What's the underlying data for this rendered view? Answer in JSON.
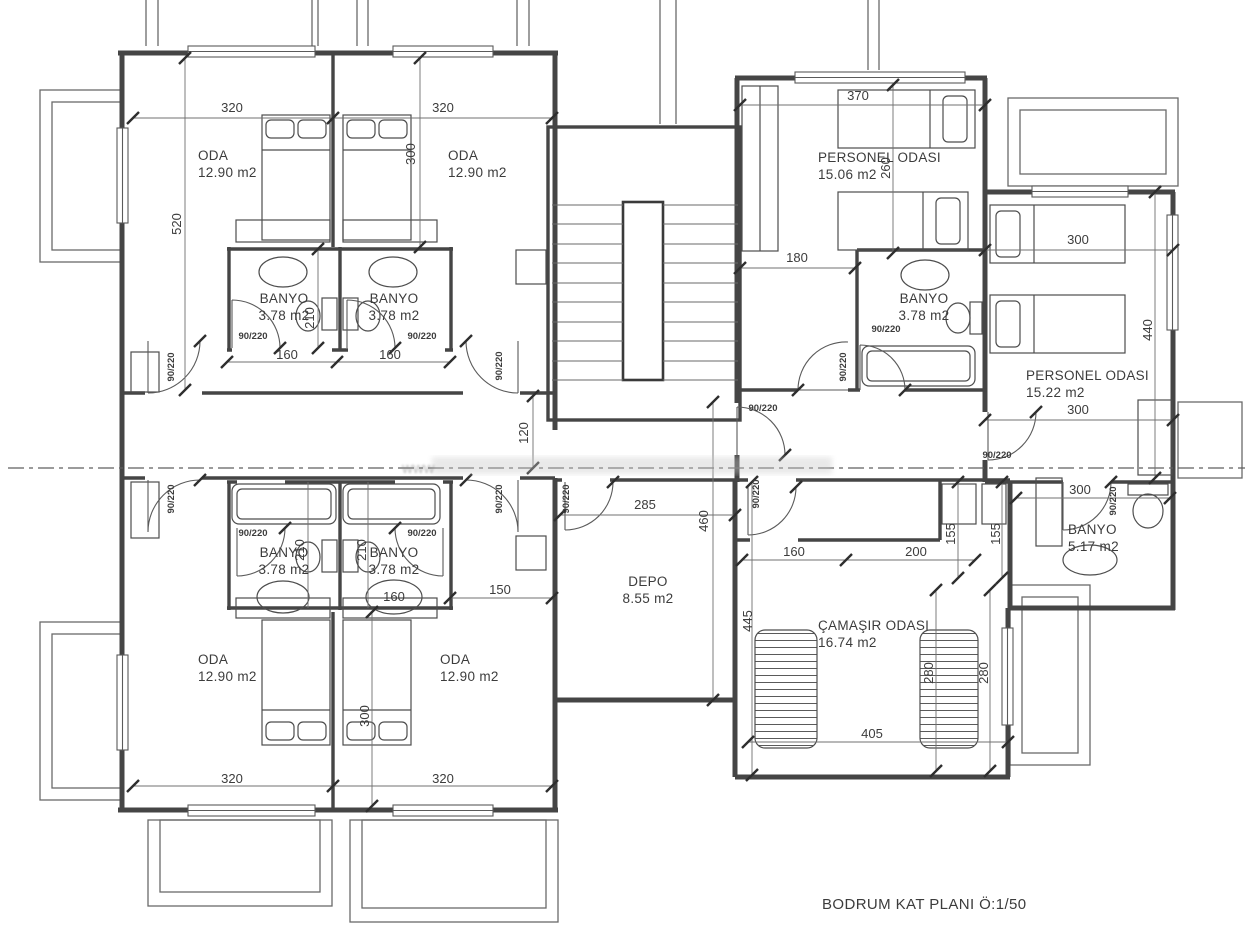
{
  "page_title": "BODRUM KAT PLANI Ö:1/50",
  "watermark_prefix": "www",
  "colors": {
    "wall": "#454545",
    "thin": "#555555",
    "dim_text": "#3c3c3c",
    "bg": "#ffffff"
  },
  "rooms": [
    {
      "id": "oda-top-left",
      "name": "ODA",
      "area": "12.90 m2",
      "x": 198,
      "y": 160,
      "a": "start"
    },
    {
      "id": "oda-top-right",
      "name": "ODA",
      "area": "12.90 m2",
      "x": 448,
      "y": 160,
      "a": "start"
    },
    {
      "id": "banyo-top-left",
      "name": "BANYO",
      "area": "3.78 m2",
      "x": 284,
      "y": 303
    },
    {
      "id": "banyo-top-right",
      "name": "BANYO",
      "area": "3.78 m2",
      "x": 394,
      "y": 303
    },
    {
      "id": "personel-odasi-1",
      "name": "PERSONEL ODASI",
      "area": "15.06 m2",
      "x": 818,
      "y": 162,
      "a": "start"
    },
    {
      "id": "personel-banyo",
      "name": "BANYO",
      "area": "3.78 m2",
      "x": 924,
      "y": 303
    },
    {
      "id": "personel-odasi-2",
      "name": "PERSONEL ODASI",
      "area": "15.22 m2",
      "x": 1026,
      "y": 380,
      "a": "start"
    },
    {
      "id": "banyo-517",
      "name": "BANYO",
      "area": "5.17 m2",
      "x": 1068,
      "y": 534,
      "a": "start"
    },
    {
      "id": "depo",
      "name": "DEPO",
      "area": "8.55 m2",
      "x": 648,
      "y": 586
    },
    {
      "id": "camasir-odasi",
      "name": "ÇAMAŞIR ODASI",
      "area": "16.74 m2",
      "x": 818,
      "y": 630,
      "a": "start"
    },
    {
      "id": "banyo-bottom-left",
      "name": "BANYO",
      "area": "3.78 m2",
      "x": 284,
      "y": 557
    },
    {
      "id": "banyo-bottom-right",
      "name": "BANYO",
      "area": "3.78 m2",
      "x": 394,
      "y": 557
    },
    {
      "id": "oda-bottom-left",
      "name": "ODA",
      "area": "12.90 m2",
      "x": 198,
      "y": 664,
      "a": "start"
    },
    {
      "id": "oda-bottom-right",
      "name": "ODA",
      "area": "12.90 m2",
      "x": 440,
      "y": 664,
      "a": "start"
    }
  ],
  "dims": [
    {
      "t": "320",
      "x": 232,
      "y": 112
    },
    {
      "t": "320",
      "x": 443,
      "y": 112
    },
    {
      "t": "520",
      "x": 181,
      "y": 224,
      "r": 1
    },
    {
      "t": "300",
      "x": 415,
      "y": 154,
      "r": 1
    },
    {
      "t": "210",
      "x": 314,
      "y": 318,
      "r": 1
    },
    {
      "t": "90/220",
      "x": 253,
      "y": 339,
      "s": 1
    },
    {
      "t": "90/220",
      "x": 422,
      "y": 339,
      "s": 1
    },
    {
      "t": "160",
      "x": 287,
      "y": 359
    },
    {
      "t": "160",
      "x": 390,
      "y": 359
    },
    {
      "t": "90/220",
      "x": 174,
      "y": 367,
      "r": 1,
      "s": 1
    },
    {
      "t": "90/220",
      "x": 502,
      "y": 366,
      "r": 1,
      "s": 1
    },
    {
      "t": "120",
      "x": 528,
      "y": 433,
      "r": 1
    },
    {
      "t": "370",
      "x": 858,
      "y": 100
    },
    {
      "t": "260",
      "x": 890,
      "y": 168,
      "r": 1
    },
    {
      "t": "180",
      "x": 797,
      "y": 262
    },
    {
      "t": "90/220",
      "x": 886,
      "y": 332,
      "s": 1
    },
    {
      "t": "90/220",
      "x": 846,
      "y": 367,
      "r": 1,
      "s": 1
    },
    {
      "t": "300",
      "x": 1078,
      "y": 244
    },
    {
      "t": "440",
      "x": 1152,
      "y": 330,
      "r": 1
    },
    {
      "t": "300",
      "x": 1078,
      "y": 414
    },
    {
      "t": "90/220",
      "x": 997,
      "y": 458,
      "s": 1
    },
    {
      "t": "90/220",
      "x": 763,
      "y": 411,
      "s": 1
    },
    {
      "t": "285",
      "x": 645,
      "y": 509
    },
    {
      "t": "460",
      "x": 708,
      "y": 521,
      "r": 1
    },
    {
      "t": "90/220",
      "x": 569,
      "y": 499,
      "r": 1,
      "s": 1
    },
    {
      "t": "90/220",
      "x": 502,
      "y": 499,
      "r": 1,
      "s": 1
    },
    {
      "t": "90/220",
      "x": 174,
      "y": 499,
      "r": 1,
      "s": 1
    },
    {
      "t": "90/220",
      "x": 759,
      "y": 494,
      "r": 1,
      "s": 1
    },
    {
      "t": "155",
      "x": 955,
      "y": 534,
      "r": 1
    },
    {
      "t": "155",
      "x": 1000,
      "y": 534,
      "r": 1
    },
    {
      "t": "300",
      "x": 1080,
      "y": 494
    },
    {
      "t": "90/220",
      "x": 1116,
      "y": 501,
      "r": 1,
      "s": 1
    },
    {
      "t": "160",
      "x": 794,
      "y": 556
    },
    {
      "t": "200",
      "x": 916,
      "y": 556
    },
    {
      "t": "445",
      "x": 752,
      "y": 621,
      "r": 1
    },
    {
      "t": "280",
      "x": 933,
      "y": 673,
      "r": 1
    },
    {
      "t": "280",
      "x": 988,
      "y": 673,
      "r": 1
    },
    {
      "t": "405",
      "x": 872,
      "y": 738
    },
    {
      "t": "210",
      "x": 304,
      "y": 550,
      "r": 1
    },
    {
      "t": "210",
      "x": 366,
      "y": 550,
      "r": 1
    },
    {
      "t": "90/220",
      "x": 253,
      "y": 536,
      "s": 1
    },
    {
      "t": "90/220",
      "x": 422,
      "y": 536,
      "s": 1
    },
    {
      "t": "160",
      "x": 394,
      "y": 601
    },
    {
      "t": "150",
      "x": 500,
      "y": 594
    },
    {
      "t": "300",
      "x": 369,
      "y": 716,
      "r": 1
    },
    {
      "t": "320",
      "x": 232,
      "y": 783
    },
    {
      "t": "320",
      "x": 443,
      "y": 783
    }
  ]
}
